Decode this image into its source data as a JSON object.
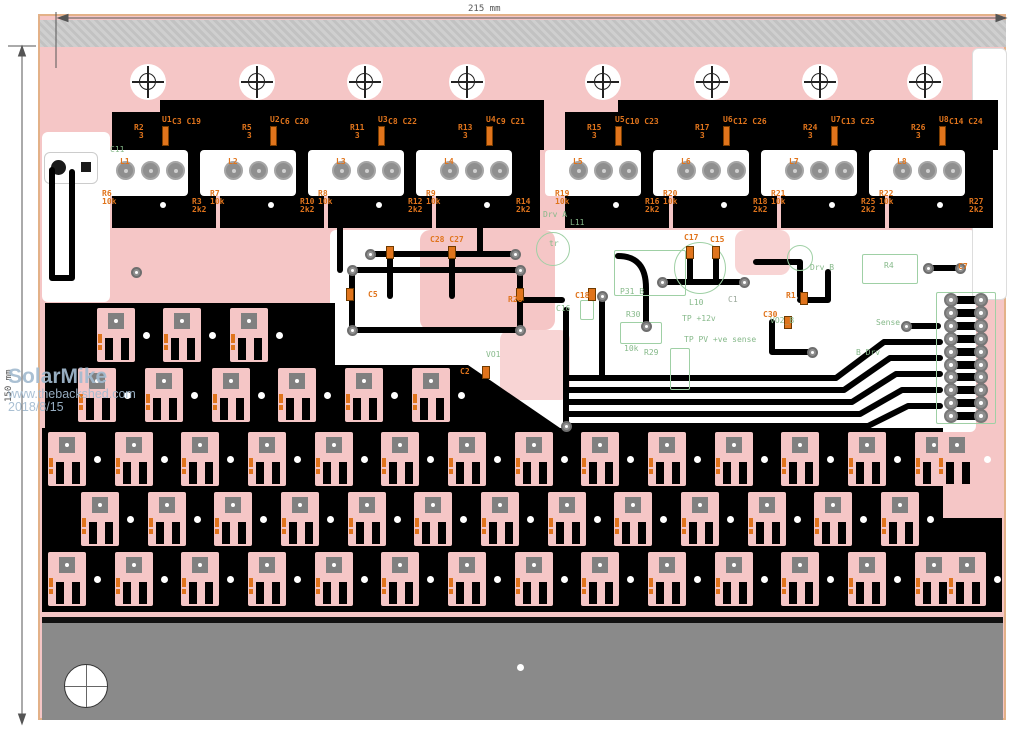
{
  "meta": {
    "title": "PCB layout - solar MPPT power board"
  },
  "dimensions": {
    "top": "215 mm",
    "left": "150 mm"
  },
  "watermark": {
    "line1": "SolarMike",
    "line2": "www.thebackshed.com",
    "line3": "2018/8/15"
  },
  "colors": {
    "copper_pour": "#f5c6c6",
    "silk_orange": "#e0741c",
    "silk_green": "#86b98a",
    "plane_black": "#000000",
    "pad_gray": "#8f8f8f",
    "bar_gray": "#8a8a8a",
    "watermark_blue": "#a3bbd0",
    "board_edge": "#e3b188"
  },
  "driver_blocks": [
    {
      "u": "U1",
      "caps": "C3 C19",
      "gate_r": "R2",
      "gate_val": "3",
      "l": "L1",
      "r_pull": [
        "R6",
        "10k"
      ],
      "r_series": [
        "R3",
        "2k2"
      ]
    },
    {
      "u": "U2",
      "caps": "C6 C20",
      "gate_r": "R5",
      "gate_val": "3",
      "l": "L2",
      "r_pull": [
        "R7",
        "10k"
      ],
      "r_series": [
        "R10",
        "2k2"
      ]
    },
    {
      "u": "U3",
      "caps": "C8 C22",
      "gate_r": "R11",
      "gate_val": "3",
      "l": "L3",
      "r_pull": [
        "R8",
        "10k"
      ],
      "r_series": [
        "R12",
        "2k2"
      ]
    },
    {
      "u": "U4",
      "caps": "C9 C21",
      "gate_r": "R13",
      "gate_val": "3",
      "l": "L4",
      "r_pull": [
        "R9",
        "10k"
      ],
      "r_series": [
        "R14",
        "2k2"
      ]
    },
    {
      "u": "U5",
      "caps": "C10 C23",
      "gate_r": "R15",
      "gate_val": "3",
      "l": "L5",
      "r_pull": [
        "R19",
        "10k"
      ],
      "r_series": [
        "R16",
        "2k2"
      ]
    },
    {
      "u": "U6",
      "caps": "C12 C26",
      "gate_r": "R17",
      "gate_val": "3",
      "l": "L6",
      "r_pull": [
        "R20",
        "10k"
      ],
      "r_series": [
        "R18",
        "2k2"
      ]
    },
    {
      "u": "U7",
      "caps": "C13 C25",
      "gate_r": "R24",
      "gate_val": "3",
      "l": "L7",
      "r_pull": [
        "R21",
        "10k"
      ],
      "r_series": [
        "R25",
        "2k2"
      ]
    },
    {
      "u": "U8",
      "caps": "C14 C24",
      "gate_r": "R26",
      "gate_val": "3",
      "l": "L8",
      "r_pull": [
        "R22",
        "10k"
      ],
      "r_series": [
        "R27",
        "2k2"
      ]
    }
  ],
  "silk_labels": [
    {
      "text": "C28 C27",
      "x": 430,
      "y": 236,
      "color": "orange"
    },
    {
      "text": "C5",
      "x": 368,
      "y": 291,
      "color": "orange"
    },
    {
      "text": "R28",
      "x": 508,
      "y": 296,
      "color": "orange"
    },
    {
      "text": "C17",
      "x": 684,
      "y": 234,
      "color": "orange"
    },
    {
      "text": "C15",
      "x": 710,
      "y": 236,
      "color": "orange"
    },
    {
      "text": "C18",
      "x": 575,
      "y": 292,
      "color": "orange"
    },
    {
      "text": "C30",
      "x": 763,
      "y": 311,
      "color": "orange"
    },
    {
      "text": "R1",
      "x": 786,
      "y": 292,
      "color": "orange"
    },
    {
      "text": "C2",
      "x": 460,
      "y": 368,
      "color": "orange"
    },
    {
      "text": "C7",
      "x": 958,
      "y": 263,
      "color": "orange"
    },
    {
      "text": "C11",
      "x": 110,
      "y": 146,
      "color": "green"
    },
    {
      "text": "Drv A",
      "x": 543,
      "y": 211,
      "color": "green"
    },
    {
      "text": "L11",
      "x": 570,
      "y": 219,
      "color": "green"
    },
    {
      "text": "tr",
      "x": 549,
      "y": 240,
      "color": "green"
    },
    {
      "text": "C16",
      "x": 556,
      "y": 305,
      "color": "green"
    },
    {
      "text": "L10",
      "x": 689,
      "y": 299,
      "color": "green"
    },
    {
      "text": "C1",
      "x": 728,
      "y": 296,
      "color": "gray"
    },
    {
      "text": "P31_B",
      "x": 620,
      "y": 288,
      "color": "green"
    },
    {
      "text": "R30",
      "x": 626,
      "y": 311,
      "color": "green"
    },
    {
      "text": "10k",
      "x": 624,
      "y": 345,
      "color": "green"
    },
    {
      "text": "TP +12v",
      "x": 682,
      "y": 315,
      "color": "green"
    },
    {
      "text": "TP PV +ve sense",
      "x": 684,
      "y": 336,
      "color": "green"
    },
    {
      "text": "R29",
      "x": 644,
      "y": 349,
      "color": "green"
    },
    {
      "text": "VO1",
      "x": 486,
      "y": 351,
      "color": "green"
    },
    {
      "text": "VO2_B",
      "x": 770,
      "y": 317,
      "color": "green"
    },
    {
      "text": "R4",
      "x": 884,
      "y": 262,
      "color": "green"
    },
    {
      "text": "Sense",
      "x": 876,
      "y": 319,
      "color": "green"
    },
    {
      "text": "B Drv",
      "x": 856,
      "y": 349,
      "color": "green"
    },
    {
      "text": "Drv B",
      "x": 810,
      "y": 264,
      "color": "green"
    }
  ],
  "connector": {
    "rows": 10
  },
  "mount_holes": {
    "y": 82,
    "xs": [
      148,
      257,
      365,
      467,
      603,
      712,
      820,
      925
    ]
  },
  "diode_rows": [
    {
      "y": 308,
      "xs": [
        97,
        163,
        230
      ]
    },
    {
      "y": 368,
      "xs": [
        78,
        145,
        212,
        278,
        345,
        412
      ]
    },
    {
      "y": 432,
      "xs": [
        48,
        115,
        181,
        248,
        315,
        381,
        448,
        515,
        581,
        648,
        715,
        781,
        848,
        915,
        938
      ]
    },
    {
      "y": 492,
      "xs": [
        81,
        148,
        214,
        281,
        348,
        414,
        481,
        548,
        614,
        681,
        748,
        814,
        881
      ]
    },
    {
      "y": 552,
      "xs": [
        48,
        115,
        181,
        248,
        315,
        381,
        448,
        515,
        581,
        648,
        715,
        781,
        848,
        915,
        948
      ]
    }
  ]
}
